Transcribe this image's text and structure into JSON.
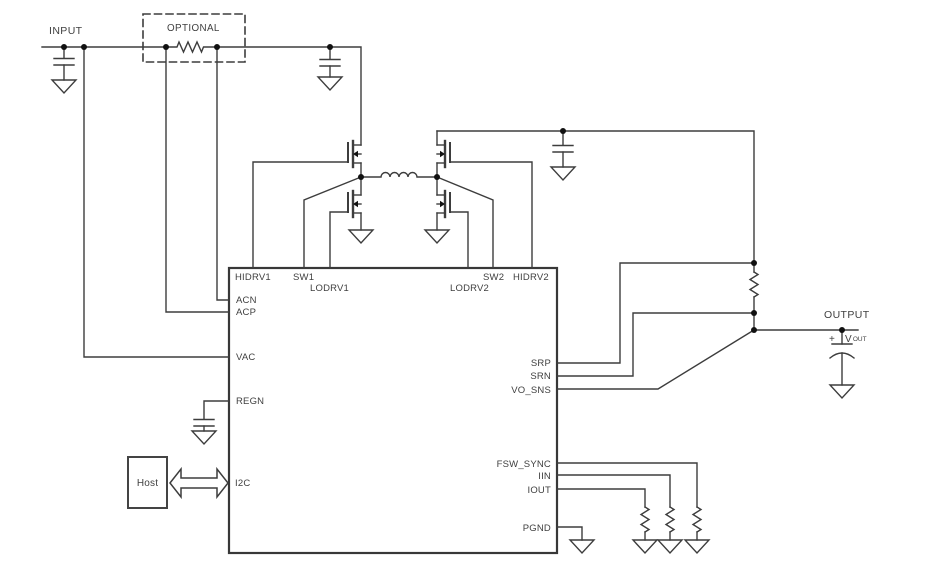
{
  "diagram": {
    "type": "power-converter-schematic",
    "labels": {
      "input": "INPUT",
      "optional": "OPTIONAL",
      "output": "OUTPUT",
      "host": "Host",
      "vout_plus": "+",
      "vout_v": "V",
      "vout_sub": "OUT"
    },
    "ic_pins": {
      "hidrv1": "HIDRV1",
      "sw1": "SW1",
      "lodrv1": "LODRV1",
      "lodrv2": "LODRV2",
      "sw2": "SW2",
      "hidrv2": "HIDRV2",
      "acn": "ACN",
      "acp": "ACP",
      "vac": "VAC",
      "regn": "REGN",
      "i2c": "I2C",
      "srp": "SRP",
      "srn": "SRN",
      "vo_sns": "VO_SNS",
      "fsw_sync": "FSW_SYNC",
      "iin": "IIN",
      "iout": "IOUT",
      "pgnd": "PGND"
    },
    "colors": {
      "background": "#ffffff",
      "wire": "#3d3d3d",
      "text": "#3f3f3f",
      "junction_dot": "#111111",
      "mosfet_arrow": "#111111"
    }
  }
}
